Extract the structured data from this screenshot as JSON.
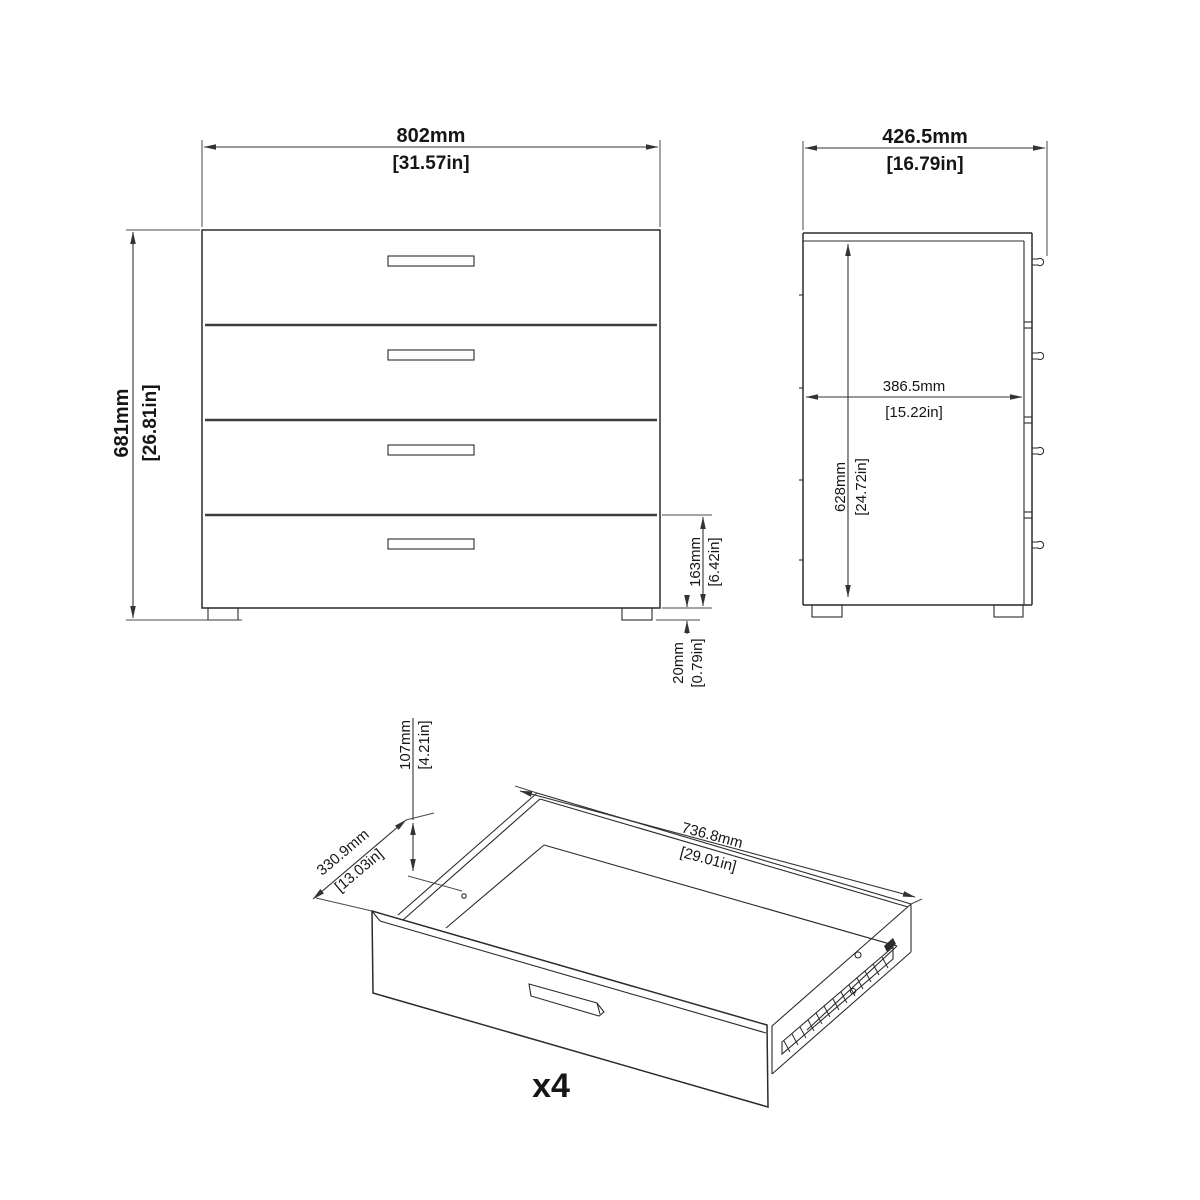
{
  "drawing_title": "4-drawer chest of drawers dimensional drawing",
  "front_view": {
    "width": {
      "mm": "802mm",
      "in": "[31.57in]"
    },
    "height": {
      "mm": "681mm",
      "in": "[26.81in]"
    },
    "drawer_height": {
      "mm": "163mm",
      "in": "[6.42in]"
    },
    "foot_height": {
      "mm": "20mm",
      "in": "[0.79in]"
    }
  },
  "side_view": {
    "depth": {
      "mm": "426.5mm",
      "in": "[16.79in]"
    },
    "inner_depth": {
      "mm": "386.5mm",
      "in": "[15.22in]"
    },
    "inner_height": {
      "mm": "628mm",
      "in": "[24.72in]"
    }
  },
  "drawer_view": {
    "height": {
      "mm": "107mm",
      "in": "[4.21in]"
    },
    "depth": {
      "mm": "330.9mm",
      "in": "[13.03in]"
    },
    "width": {
      "mm": "736.8mm",
      "in": "[29.01in]"
    },
    "quantity": "x4"
  },
  "colors": {
    "line": "#2b2b2b",
    "dimension": "#333333",
    "text": "#161616",
    "background": "#ffffff"
  }
}
